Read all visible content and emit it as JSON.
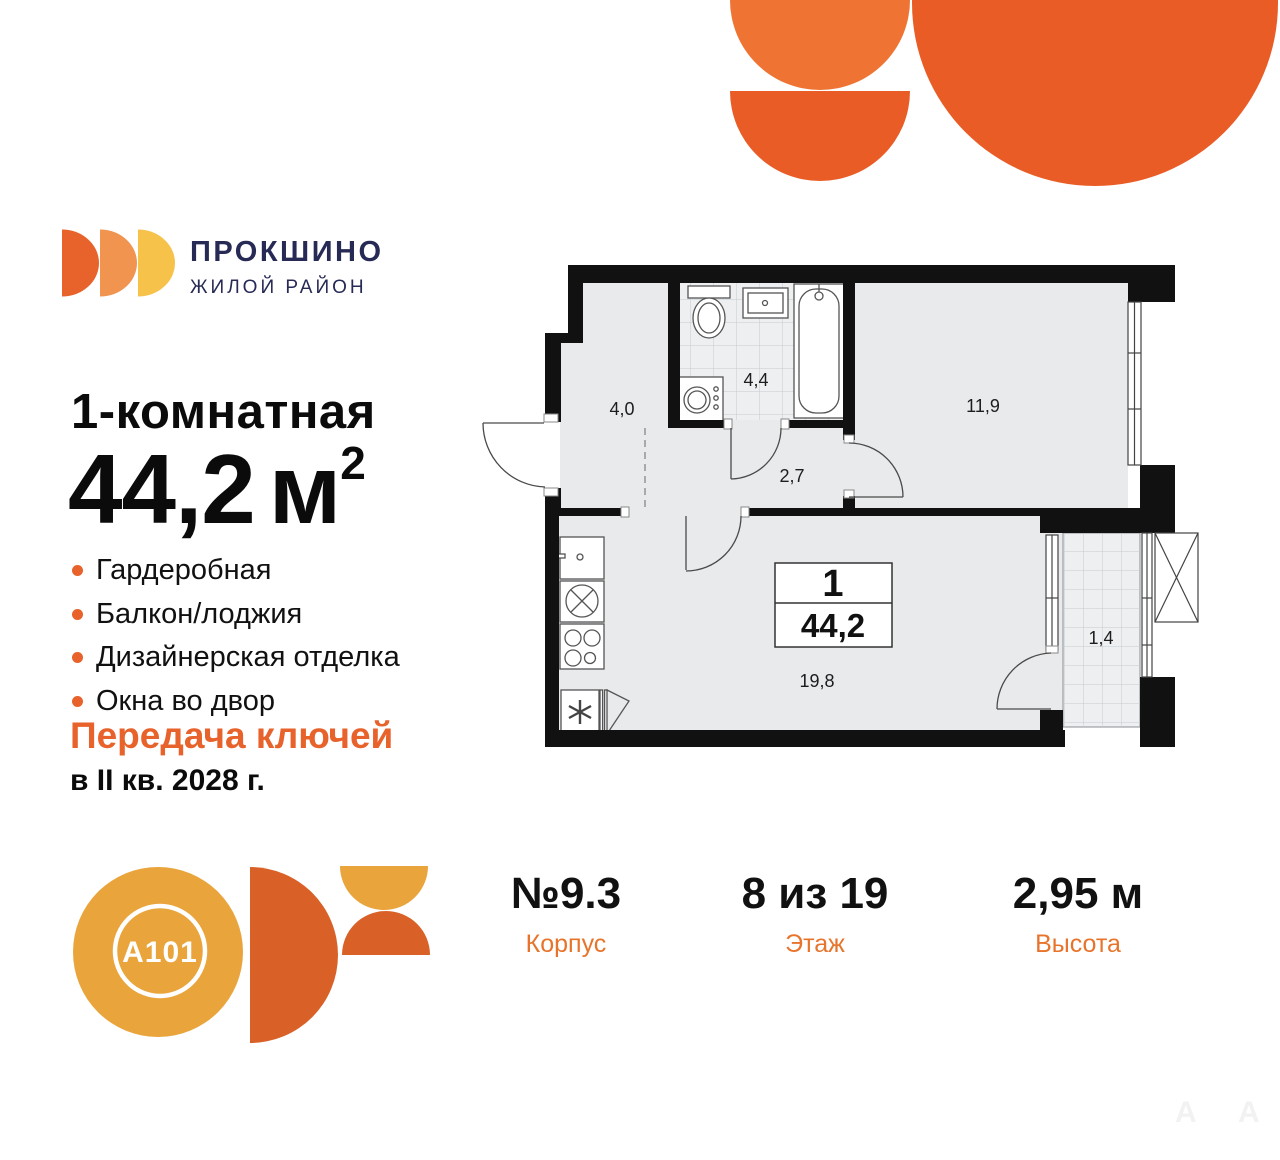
{
  "brand": {
    "name": "ПРОКШИНО",
    "tagline": "ЖИЛОЙ РАЙОН"
  },
  "listing": {
    "title": "1-комнатная",
    "area_value": "44,2",
    "area_unit": "м",
    "area_sup": "2",
    "features": [
      "Гардеробная",
      "Балкон/лоджия",
      "Дизайнерская отделка",
      "Окна во двор"
    ],
    "handover_line1": "Передача ключей",
    "handover_line2": "в II кв. 2028 г."
  },
  "floorplan": {
    "plan_number": "1",
    "plan_area": "44,2",
    "rooms": [
      {
        "name": "hallway",
        "area": "4,0"
      },
      {
        "name": "bathroom",
        "area": "4,4"
      },
      {
        "name": "corridor",
        "area": "2,7"
      },
      {
        "name": "bedroom",
        "area": "11,9"
      },
      {
        "name": "kitchen-living",
        "area": "19,8"
      },
      {
        "name": "balcony",
        "area": "1,4"
      }
    ]
  },
  "stats": [
    {
      "value": "№9.3",
      "label": "Корпус"
    },
    {
      "value": "8 из 19",
      "label": "Этаж"
    },
    {
      "value": "2,95 м",
      "label": "Высота"
    }
  ],
  "developer": {
    "logo_text": "A101"
  },
  "watermark": [
    "A",
    "A"
  ],
  "colors": {
    "accent_orange": "#E8622B",
    "deco_orange": "#E95C26",
    "deco_orange_light": "#EF7433",
    "gold": "#E9A43B",
    "rust": "#D96127",
    "navy": "#272A55",
    "plan_fill": "#E9EAEC",
    "wall": "#111111"
  }
}
